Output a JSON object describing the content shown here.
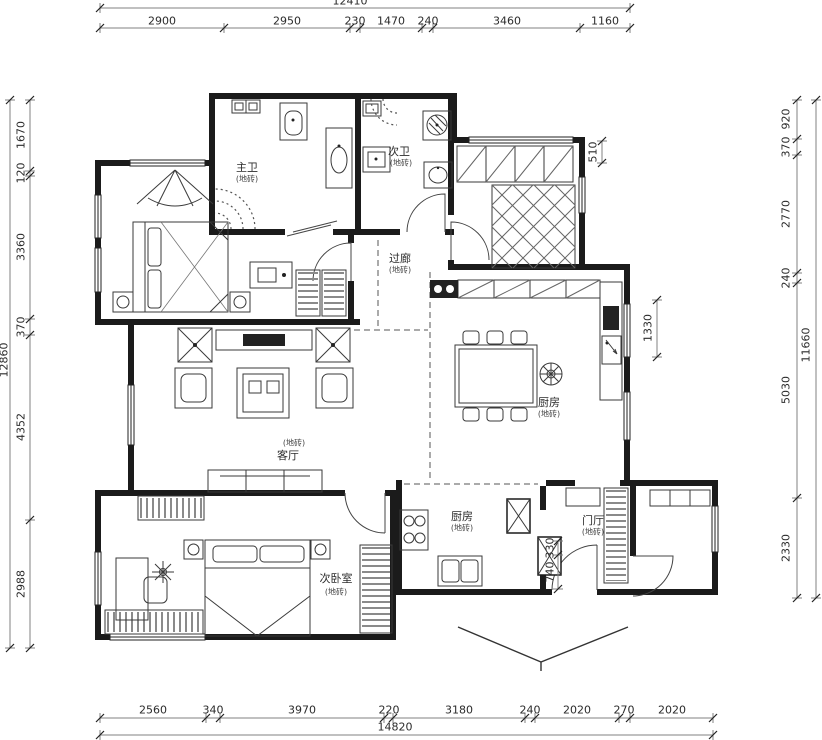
{
  "dimensions": {
    "top": {
      "total": "12410",
      "segments": [
        "2900",
        "2950",
        "230",
        "1470",
        "240",
        "3460",
        "1160"
      ]
    },
    "bottom": {
      "total": "14820",
      "segments": [
        "2560",
        "340",
        "3970",
        "220",
        "3180",
        "240",
        "2020",
        "270",
        "2020"
      ]
    },
    "left": {
      "total": "12860",
      "segments": [
        "1670",
        "120",
        "3360",
        "370",
        "4352",
        "2988"
      ]
    },
    "right": {
      "total": "11660",
      "segments": [
        "920",
        "370",
        "2770",
        "240",
        "5030",
        "2330"
      ]
    },
    "interior": {
      "d510": "510",
      "d1330": "1330",
      "d330": "330",
      "d740": "740"
    }
  },
  "rooms": {
    "master_bath": {
      "name": "主卫",
      "finish": "(地砖)"
    },
    "second_bath": {
      "name": "次卫",
      "finish": "(地砖)"
    },
    "corridor": {
      "name": "过廊",
      "finish": "(地砖)"
    },
    "dining": {
      "name": "厨房",
      "finish": "(地砖)"
    },
    "kitchen": {
      "name": "厨房",
      "finish": "(地砖)"
    },
    "living": {
      "name": "客厅",
      "finish": "(地砖)"
    },
    "second_bedroom": {
      "name": "次卧室",
      "finish": "(地砖)"
    },
    "entry": {
      "name": "门厅",
      "finish": "(地砖)"
    }
  }
}
